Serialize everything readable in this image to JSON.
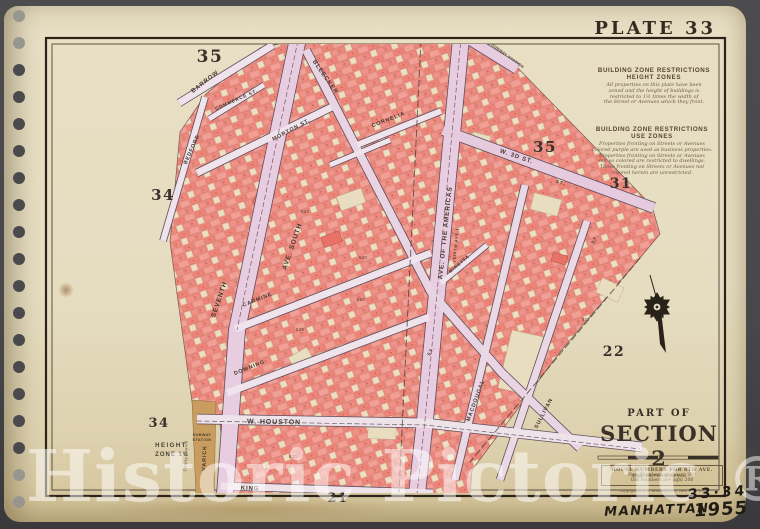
{
  "plate": {
    "label": "PLATE 33"
  },
  "zone_notes": {
    "height": {
      "title": "BUILDING ZONE RESTRICTIONS",
      "subtitle": "HEIGHT ZONES",
      "lines": [
        "All properties on this plate have been",
        "zoned and the height of buildings is",
        "restricted to 1½ times the width of",
        "the Street or Avenues which they front."
      ]
    },
    "use": {
      "title": "BUILDING ZONE RESTRICTIONS",
      "subtitle": "USE ZONES",
      "lines": [
        "Properties fronting on Streets or Avenues",
        "colored purple are used as business properties.",
        "Properties fronting on Streets or Avenues",
        "not so colored are restricted to dwellings.",
        "Those fronting on Streets or Avenues not",
        "colored herein are unrestricted."
      ]
    }
  },
  "section_label": {
    "part_of": "PART OF",
    "name": "SECTION 2",
    "scale_note": "Scale 100 Feet to the Inch"
  },
  "house_note": {
    "lines": [
      "HOUSE NUMBERS FOR 6TH AVE.",
      "New Numbers are heavy  200",
      "Old Numbers are light  200"
    ],
    "copyright": "Copyright by G.W. Bromley & Co., New York, N.Y."
  },
  "handwriting": {
    "plates": "33·34",
    "borough": "MANHATTAN",
    "year": "1955"
  },
  "watermark": {
    "text": "Historic Pictoric",
    "mark": "®"
  },
  "map": {
    "adjacent_plates": [
      {
        "label": "35",
        "x": 210,
        "y": 62,
        "size": 17
      },
      {
        "label": "34",
        "x": 163,
        "y": 200,
        "size": 15
      },
      {
        "label": "35",
        "x": 545,
        "y": 152,
        "size": 15
      },
      {
        "label": "31",
        "x": 621,
        "y": 188,
        "size": 14
      },
      {
        "label": "22",
        "x": 614,
        "y": 356,
        "size": 14
      },
      {
        "label": "34",
        "x": 159,
        "y": 427,
        "size": 13
      },
      {
        "label": "21",
        "x": 338,
        "y": 502,
        "size": 13
      }
    ],
    "street_labels": [
      {
        "text": "BARROW",
        "x": 206,
        "y": 83,
        "rot": -38,
        "size": 6
      },
      {
        "text": "COMMERCE ST.",
        "x": 237,
        "y": 101,
        "rot": -24,
        "size": 4.6
      },
      {
        "text": "BEDFORD",
        "x": 193,
        "y": 150,
        "rot": -66,
        "size": 5.2
      },
      {
        "text": "MORTON ST.",
        "x": 292,
        "y": 131,
        "rot": -28,
        "size": 5.4
      },
      {
        "text": "BLEECKER",
        "x": 324,
        "y": 78,
        "rot": 55,
        "size": 6
      },
      {
        "text": "SEVENTH",
        "x": 221,
        "y": 300,
        "rot": -71,
        "size": 6.6
      },
      {
        "text": "AVE. SOUTH",
        "x": 294,
        "y": 247,
        "rot": -71,
        "size": 6.6
      },
      {
        "text": "CORNELIA",
        "x": 389,
        "y": 121,
        "rot": -21,
        "size": 5.4
      },
      {
        "text": "W. 3D ST.",
        "x": 516,
        "y": 158,
        "rot": 19,
        "size": 6
      },
      {
        "text": "AVE. OF THE AMERICAS",
        "x": 447,
        "y": 233,
        "rot": -84,
        "size": 6.4
      },
      {
        "text": "(SIXTH AVE.)",
        "x": 457,
        "y": 245,
        "rot": -84,
        "size": 3.8
      },
      {
        "text": "CARMINE",
        "x": 258,
        "y": 301,
        "rot": -22,
        "size": 5.4
      },
      {
        "text": "DOWNING",
        "x": 250,
        "y": 369,
        "rot": -22,
        "size": 5.4
      },
      {
        "text": "MINETTA",
        "x": 460,
        "y": 265,
        "rot": -40,
        "size": 4.4
      },
      {
        "text": "MACDOUGAL",
        "x": 477,
        "y": 401,
        "rot": -70,
        "size": 5.4
      },
      {
        "text": "SULLIVAN",
        "x": 545,
        "y": 414,
        "rot": -62,
        "size": 5.4
      },
      {
        "text": "W. HOUSTON",
        "x": 274,
        "y": 424,
        "rot": 1,
        "size": 7
      },
      {
        "text": "KING",
        "x": 250,
        "y": 490,
        "rot": 2,
        "size": 6
      },
      {
        "text": "VARICK",
        "x": 206,
        "y": 458,
        "rot": -88,
        "size": 5.4
      },
      {
        "text": "ST.",
        "x": 560,
        "y": 184,
        "rot": 19,
        "size": 4.6
      },
      {
        "text": "ST.",
        "x": 596,
        "y": 240,
        "rot": -62,
        "size": 4.6
      },
      {
        "text": "ST.",
        "x": 432,
        "y": 352,
        "rot": -62,
        "size": 4.6
      }
    ],
    "annotations": [
      {
        "text": "HEIGHT",
        "x": 171,
        "y": 447,
        "rot": 0,
        "size": 6,
        "ls": 1.5
      },
      {
        "text": "ZONE 1½",
        "x": 172,
        "y": 456,
        "rot": 0,
        "size": 6,
        "ls": 1
      },
      {
        "text": "SUBWAY",
        "x": 202,
        "y": 436,
        "rot": 0,
        "size": 3.8,
        "ls": 0.4
      },
      {
        "text": "STATION",
        "x": 202,
        "y": 441,
        "rot": 0,
        "size": 3.8,
        "ls": 0.4
      },
      {
        "text": "SUBWAY STATION",
        "x": 507,
        "y": 57,
        "rot": 36,
        "size": 3.8,
        "ls": 0.4
      },
      {
        "text": "Trinity Church",
        "x": 187,
        "y": 456,
        "rot": -88,
        "size": 3.8,
        "ls": 0.2,
        "italic": true
      }
    ],
    "block_numbers": [
      {
        "label": "543",
        "x": 305,
        "y": 213
      },
      {
        "label": "540",
        "x": 363,
        "y": 259
      },
      {
        "label": "529",
        "x": 300,
        "y": 331
      },
      {
        "label": "527",
        "x": 586,
        "y": 321
      },
      {
        "label": "582",
        "x": 361,
        "y": 301
      },
      {
        "label": "820",
        "x": 293,
        "y": 458
      }
    ]
  },
  "colors": {
    "paper": "#e6ddc1",
    "backdrop": "#48484b",
    "block_salmon": "#f0948a",
    "avenue_pink": "#e8cde0",
    "street_lavender": "#f0e4ec",
    "ink": "#3a3128",
    "tan_buildings": "#c89d5f",
    "watermark_white": "rgba(255,255,255,0.5)"
  }
}
